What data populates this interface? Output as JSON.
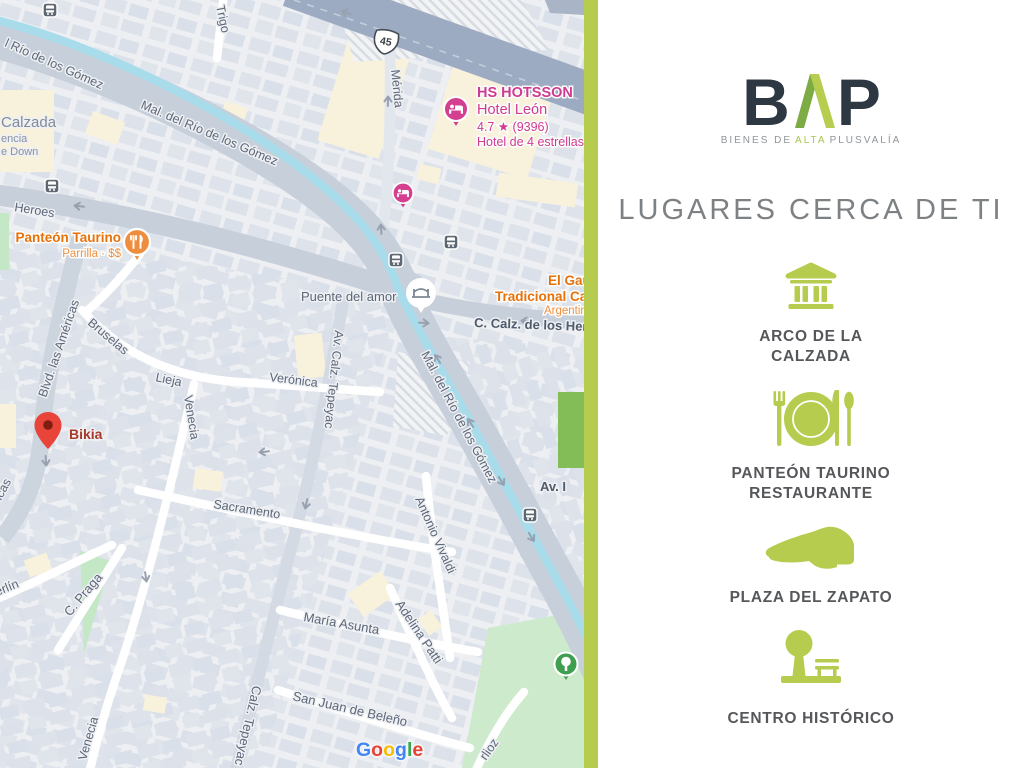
{
  "brand": {
    "letters": {
      "b": "B",
      "p": "P"
    },
    "tagline": {
      "part1": "BIENES DE",
      "highlight": "ALTA",
      "part2": "PLUSVALÍA"
    }
  },
  "heading": "LUGARES CERCA DE TI",
  "places": [
    {
      "icon": "monument-icon",
      "lines": [
        "ARCO DE LA",
        "CALZADA"
      ]
    },
    {
      "icon": "restaurant-icon",
      "lines": [
        "PANTEÓN TAURINO",
        "RESTAURANTE"
      ]
    },
    {
      "icon": "shoe-icon",
      "lines": [
        "PLAZA DEL ZAPATO"
      ]
    },
    {
      "icon": "park-icon",
      "lines": [
        "CENTRO HISTÓRICO"
      ]
    }
  ],
  "colors": {
    "accent_green": "#b5cc4e",
    "logo_green_dark": "#7dab44",
    "logo_dark": "#2d3843",
    "heading_gray": "#7e8184",
    "label_gray": "#55575b",
    "poi_orange": "#e8710a",
    "poi_pink": "#cf3a92",
    "pin_red": "#e8443a",
    "river_blue": "#a9dcea"
  },
  "map": {
    "street_labels": {
      "rio_gomez_topleft": "l Río de los Gómez",
      "malecon_upper": "Mal. del Río de los Gómez",
      "malecon_lower": "Mal. del Río de los Gómez",
      "trigo": "Trigo",
      "merida": "Mérida",
      "heroes": "Heroes",
      "c_calz_heroes": "C. Calz. de los Her",
      "puente_del_amor": "Puente del amor",
      "blvd_americas": "Blvd. las Américas",
      "americas_fragment": "icas",
      "bruselas": "Bruselas",
      "lieja": "Lieja",
      "veronica": "Verónica",
      "venecia_upper": "Venecia",
      "venecia_lower": "Venecia",
      "av_calz_tepeyac": "Av. Calz. Tepeyac",
      "calz_tepeyac": "Calz. Tepeyac",
      "sacramento": "Sacramento",
      "antonio_vivaldi": "Antonio Vivaldi",
      "maria_asunta": "María Asunta",
      "adelina_patti": "Adelina Patti",
      "san_juan_beleno": "San Juan de Beleño",
      "berlin_fragment": "erlín",
      "c_praga": "C. Praga",
      "berlioz_fragment": "rlioz",
      "av_fragment": "Av. I"
    },
    "area_labels": {
      "calzada": "Calzada",
      "encia_fragment": "encia",
      "down_fragment": "e Down"
    },
    "highway_shield": "45",
    "pois": {
      "hotel": {
        "name": "HS HOTSSON",
        "subname": "Hotel León",
        "rating_line": "4.7 ★ (9396)",
        "category": "Hotel de 4 estrellas"
      },
      "panteon_taurino": {
        "name": "Panteón Taurino",
        "detail": "Parrilla · $$"
      },
      "el_gaucho": {
        "line1": "El Gau",
        "line2": "Tradicional Calz",
        "line3": "Argentina"
      },
      "bikia": {
        "name": "Bikia"
      }
    },
    "google_letters": [
      "G",
      "o",
      "o",
      "g",
      "l",
      "e"
    ]
  }
}
